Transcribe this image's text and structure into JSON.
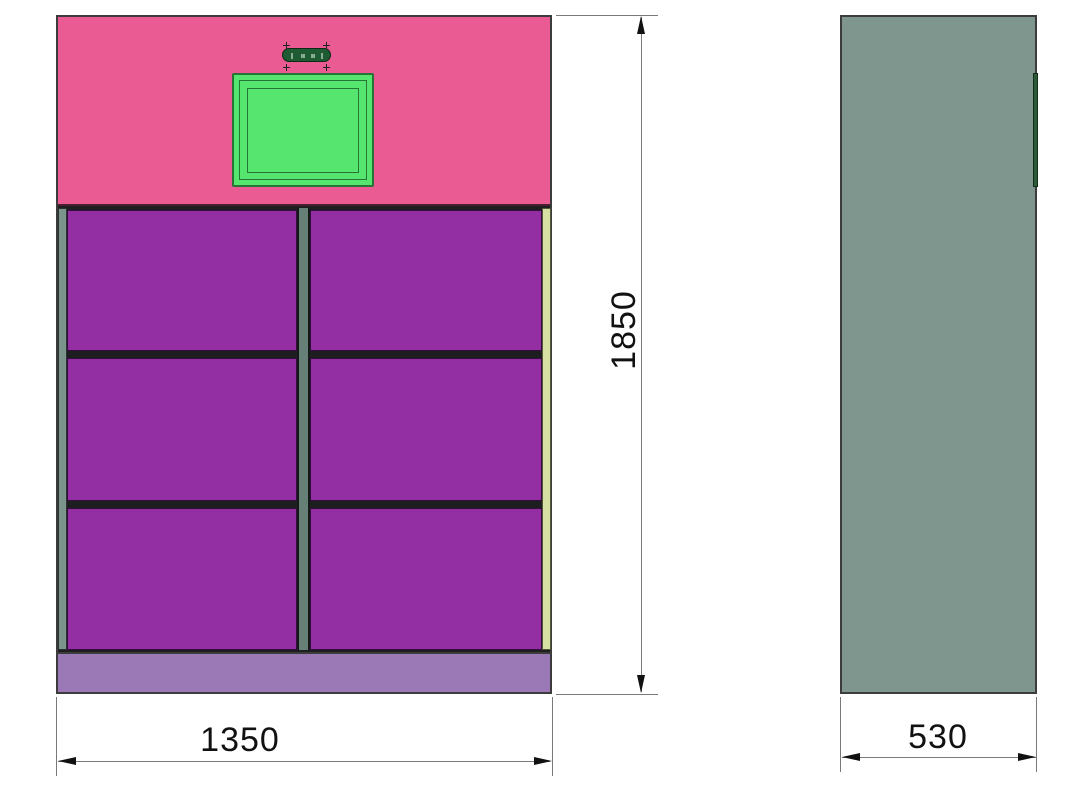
{
  "drawing": {
    "type": "cad-orthographic-drawing",
    "subject": "smart locker cabinet with touchscreen, 6 doors (2 columns x 3 rows)",
    "views": {
      "front": {
        "label": "front-view"
      },
      "side": {
        "label": "side-view"
      }
    },
    "dimensions": {
      "height": {
        "value": "1850"
      },
      "width": {
        "value": "1350"
      },
      "depth": {
        "value": "530"
      }
    },
    "colors": {
      "header_pink": "#e95b92",
      "door_purple": "#932fa3",
      "base_lavender": "#9a79b6",
      "frame_sage": "#7b948c",
      "right_edge_strip": "#d7e0a3",
      "screen_green": "#56e56e",
      "screen_border_green": "#267536",
      "camera_pill_green": "#1e5a32",
      "side_panel_gray_green": "#7e968e",
      "side_screen_edge_green": "#2d5a39",
      "dimension_line_gray": "#7a7a7a",
      "dimension_text": "#111111",
      "outline_dark": "#3c3c3c"
    }
  }
}
